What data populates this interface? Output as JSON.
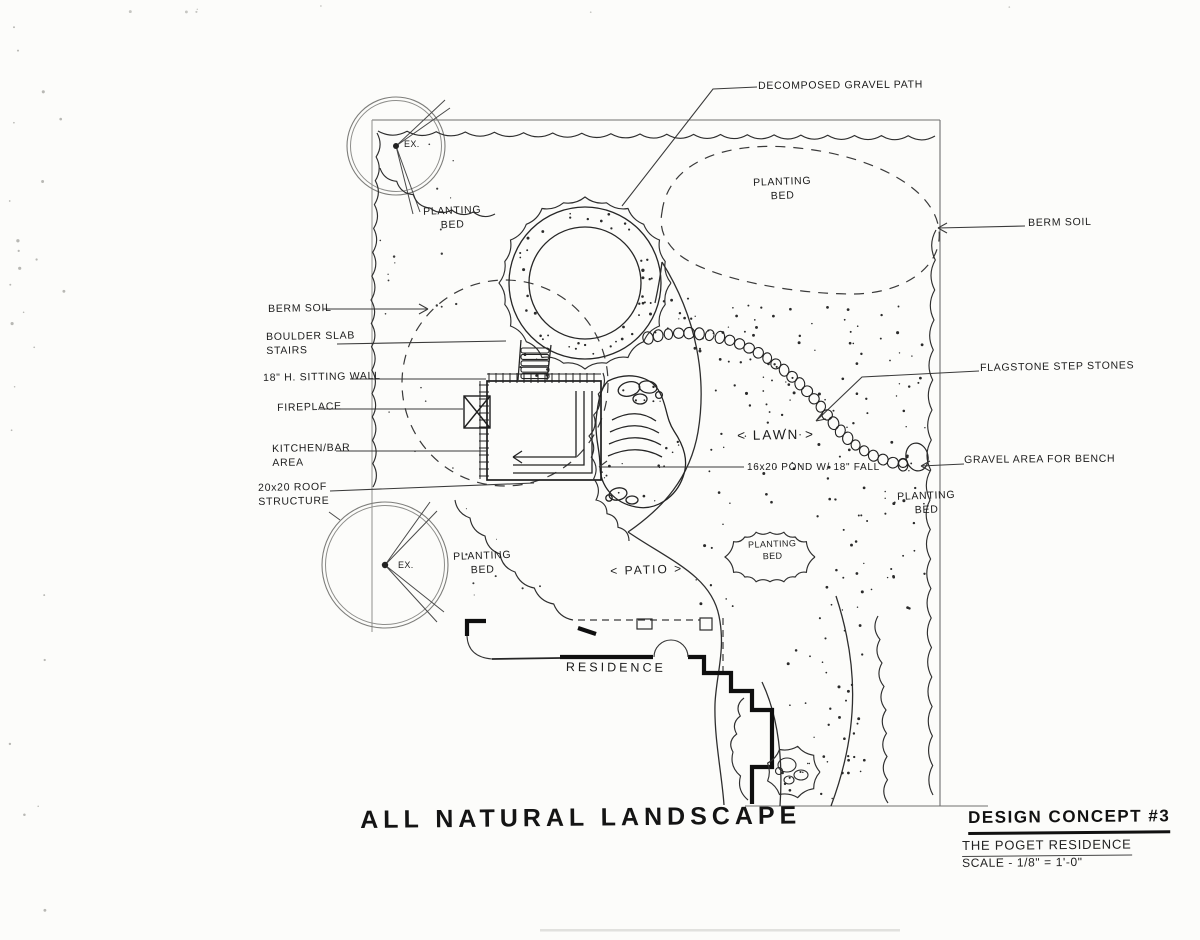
{
  "colors": {
    "ink": "#1f1f1f",
    "paper": "#fcfcfa"
  },
  "drawing": {
    "callouts": {
      "decomposed_gravel_path": "DECOMPOSED GRAVEL PATH",
      "berm_soil_left": "BERM SOIL",
      "boulder_slab_stairs": "BOULDER SLAB STAIRS",
      "sitting_wall": "18\" H. SITTING WALL",
      "fireplace": "FIREPLACE",
      "kitchen_bar_area": "KITCHEN/BAR AREA",
      "roof_structure": "20x20 ROOF STRUCTURE",
      "berm_soil_right": "BERM SOIL",
      "flagstone_step_stones": "FLAGSTONE STEP STONES",
      "gravel_area_for_bench": "GRAVEL AREA FOR BENCH",
      "pond": "16x20 POND W/ 18\" FALL"
    },
    "areas": {
      "planting_bed": "PLANTING BED",
      "lawn": "< LAWN >",
      "patio": "< PATIO >",
      "residence": "RESIDENCE",
      "existing_tree": "EX."
    },
    "title": "ALL NATURAL LANDSCAPE",
    "title_block": {
      "concept": "DESIGN CONCEPT #3",
      "client": "THE POGET RESIDENCE",
      "scale": "SCALE - 1/8\" = 1'-0\""
    }
  }
}
